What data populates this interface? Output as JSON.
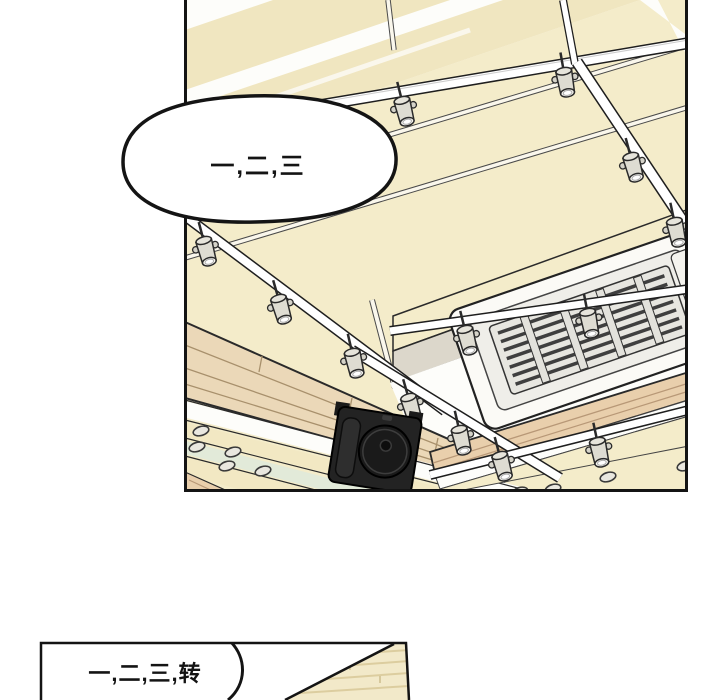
{
  "panels": {
    "top": {
      "bubble_text": "一,二,三"
    },
    "bottom": {
      "bubble_text": "一,二,三,转"
    }
  },
  "colors": {
    "outline": "#141414",
    "ceiling_cream": "#f4ecca",
    "ceiling_cream_dark": "#f0e6c0",
    "wood_beam": "#ebd8b8",
    "wood_fascia": "#e9cfac",
    "glass_green": "#e2ead9",
    "duct_gray": "#dcd7cb",
    "speaker_black": "#232323",
    "spotlight_gray": "#dedcd2"
  }
}
